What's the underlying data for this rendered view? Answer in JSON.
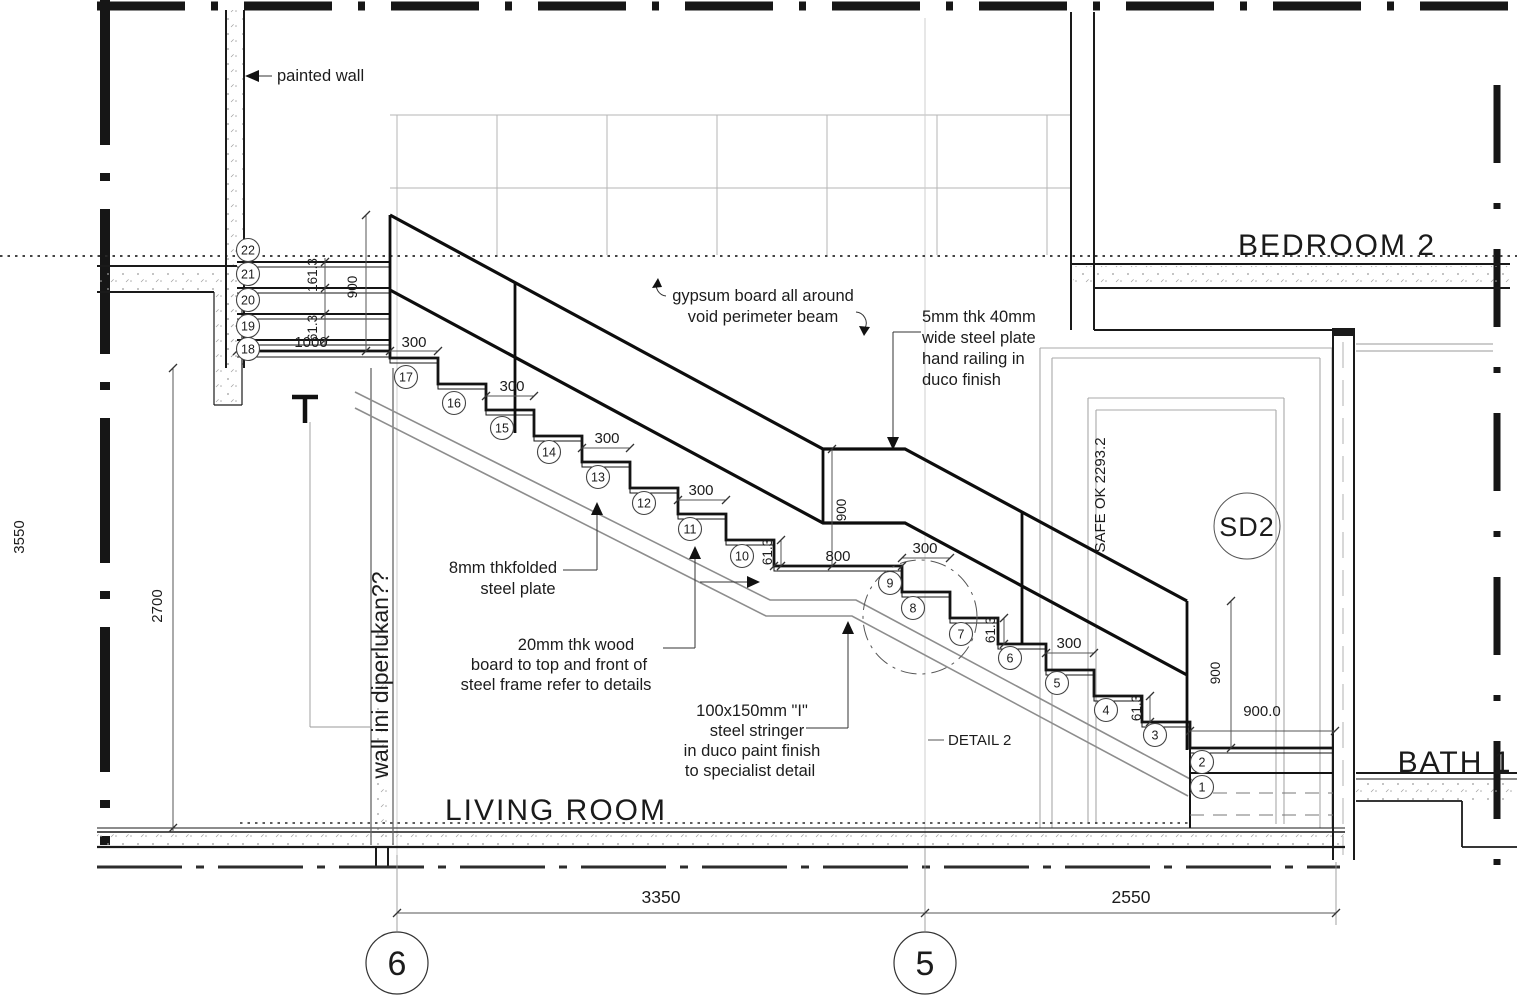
{
  "drawing": {
    "rooms": {
      "bedroom2": "BEDROOM 2",
      "living_room": "LIVING ROOM",
      "bath1": "BATH 1"
    },
    "door_tag": "SD2",
    "grid_bubbles": {
      "left": "6",
      "right": "5"
    },
    "annotations": {
      "painted_wall": "painted wall",
      "gypsum_line1": "gypsum board all around",
      "gypsum_line2": "void perimeter beam",
      "handrail_line1": "5mm thk 40mm",
      "handrail_line2": "wide steel plate",
      "handrail_line3": "hand railing in",
      "handrail_line4": "duco finish",
      "plate_line1": "8mm thkfolded",
      "plate_line2": "steel plate",
      "wood_line1": "20mm thk  wood",
      "wood_line2": "board to top and front of",
      "wood_line3": "steel frame refer to details",
      "stringer_line1": "100x150mm \"I\"",
      "stringer_line2": "steel stringer",
      "stringer_line3": "in duco paint finish",
      "stringer_line4": "to specialist detail",
      "detail_ref": "DETAIL 2",
      "wall_question": "wall ini diperlukan??",
      "safe_level": "SAFE  OK 2293.2"
    },
    "dimensions": {
      "overall_height": "3550",
      "floor_height": "2700",
      "riser_pair_top": "161.3",
      "riser_small": "61.3",
      "rail_height": "900",
      "rail_height_right": "900",
      "landing_width": "1000",
      "tread": "300",
      "mid_landing": "800",
      "platform_width": "900.0",
      "span_left": "3350",
      "span_right": "2550"
    },
    "steps": {
      "numbers": [
        1,
        2,
        3,
        4,
        5,
        6,
        7,
        8,
        9,
        10,
        11,
        12,
        13,
        14,
        15,
        16,
        17,
        18,
        19,
        20,
        21,
        22
      ]
    }
  }
}
